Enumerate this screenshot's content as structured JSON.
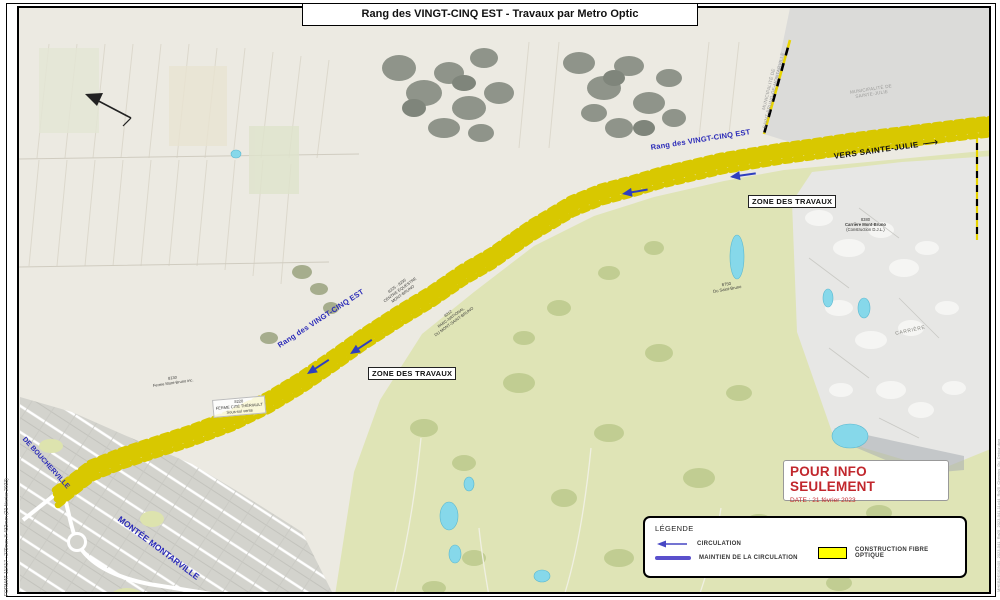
{
  "sheet": {
    "title": "Rang des VINGT-CINQ EST  - Travaux par Metro Optic",
    "format_note": "FORMAT 11X17 : 279mm X 432mm (21 février 2023)",
    "file_note": "MHEBDESIGN05_2023-041_Rg25_2023-041-11x44_Rg25_Chemins_Du_Detour.dwg"
  },
  "map": {
    "road_name": "Rang des VINGT-CINQ EST",
    "direction_label": "VERS SAINTE-JULIE",
    "direction_arrow": "⟶",
    "work_zone_label": "ZONE DES TRAVAUX",
    "municipalities": {
      "sainte_julie": [
        "MUNICIPALITÉ DE",
        "SAINTE-JULIE"
      ],
      "saint_bruno": [
        "MUNICIPALITÉ DE",
        "SAINT-BRUNO-DE-MONTARVILLE"
      ]
    },
    "streets": {
      "montee": "MONTÉE MONTARVILLE",
      "boucherville": "DE BOUCHERVILLE"
    },
    "pois": [
      {
        "lines": [
          "8225 - 8235",
          "CENTRE ÉQUESTRE",
          "MONT-BRUNO"
        ]
      },
      {
        "lines": [
          "8312",
          "PARC-NATIONAL",
          "DU MONT-SAINT-BRUNO"
        ]
      },
      {
        "lines": [
          "8750",
          "Du Saint-Bruno"
        ]
      },
      {
        "lines": [
          "8130",
          "Ferme Mont-Bruno inc."
        ]
      },
      {
        "lines": [
          "8220",
          "FERME CITÉ THÉRIAULT",
          "Sous-sol vente"
        ]
      },
      {
        "lines": [
          "8380",
          "Carrière Mont-Bruno",
          "(Construction D.J.L.)"
        ]
      },
      {
        "lines": [
          "CARRIÈRE"
        ]
      }
    ]
  },
  "info_box": {
    "title": "POUR INFO SEULEMENT",
    "date_label": "DATE :",
    "date_value": "21 février 2023"
  },
  "legend": {
    "title": "LÉGENDE",
    "items": [
      {
        "label": "CIRCULATION"
      },
      {
        "label": "MAINTIEN DE LA CIRCULATION"
      },
      {
        "label": "CONSTRUCTION FIBRE OPTIQUE"
      }
    ]
  },
  "colors": {
    "fibre_yellow": "#ffff00",
    "maintien_violet": "#5a50cc",
    "detour_magenta": "#c83cc8",
    "circulation_blue": "#2f3fbf",
    "boundary_yellow": "#e8d400",
    "info_red": "#c1272d",
    "road_label_blue": "#2a2ab8",
    "park_green": "#dfe4b6",
    "pond_cyan": "#86d8ea"
  }
}
